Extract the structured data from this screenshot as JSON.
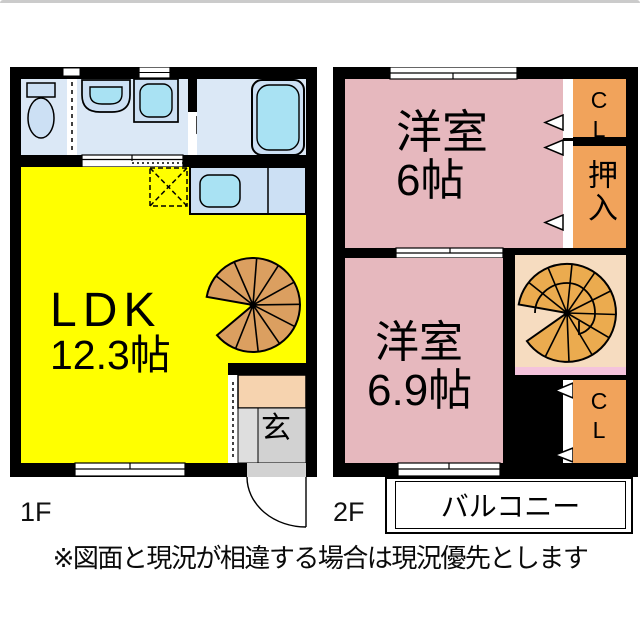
{
  "floor1": {
    "label": "1F",
    "room_ldk": {
      "name": "LDK",
      "size": "12.3帖"
    },
    "entrance_label": "玄"
  },
  "floor2": {
    "label": "2F",
    "room_top": {
      "name": "洋室",
      "size": "6帖"
    },
    "room_bottom": {
      "name": "洋室",
      "size": "6.9帖"
    },
    "closet_top": "CL",
    "oshiire": "押入",
    "closet_bottom": "CL",
    "balcony_label": "バルコニー"
  },
  "disclaimer": "※図面と現況が相違する場合は現況優先とします",
  "colors": {
    "ldk_yellow": "#FFFF00",
    "room_pink": "#E6B8BE",
    "closet_orange": "#F1A35B",
    "stair1_tan": "#DB9F60",
    "stair2_orange": "#EBAB4F",
    "stair_room_peach": "#F6DCC0",
    "stair_band_pink": "#F4C3DC",
    "wet_room_blue": "#DBE8F6",
    "fixture_blue": "#CCE0F4",
    "fixture_cyan": "#A9E2F3",
    "entrance_gray": "#D2D2D2",
    "entrance_gray_light": "#DEDEDE",
    "step_peach": "#F6D3AF",
    "balcony_gray": "#DCD4C9",
    "wall_black": "#000000"
  }
}
